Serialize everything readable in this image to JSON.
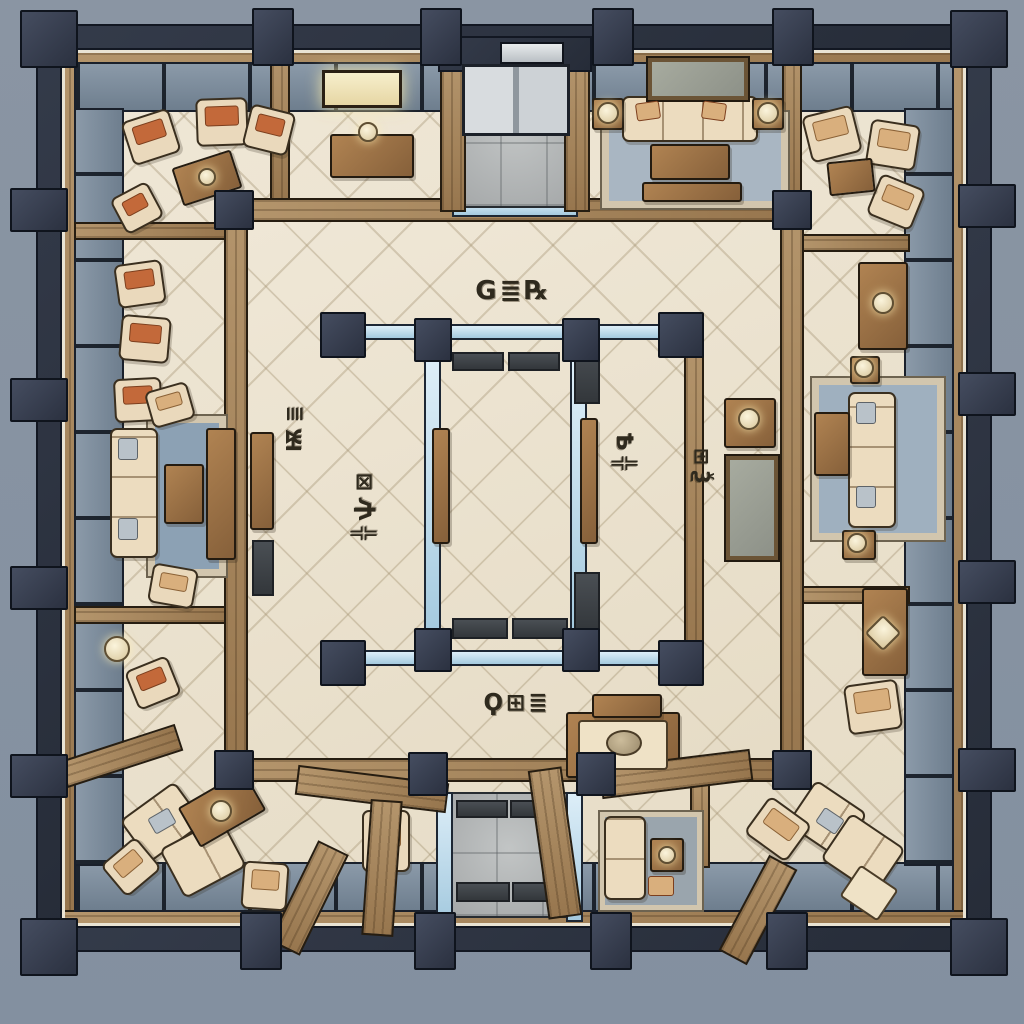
{
  "scene": {
    "description": "Hand-drawn top-down floor plan of a square building: dark structural frame with columns, perimeter wood and glass walls, beige tiled lounge rooms with sofas and armchairs, central grey stone court with elevator and glass partitions",
    "view": "top-down"
  },
  "labels": {
    "north_room": "G≣℞",
    "west_wing": "Ѭ≣",
    "court_west": "╬ѱ⊠",
    "court_east": "Ѣ╬",
    "east_wing": "⊞Ѯ",
    "south_room": "Ϙ⊞≣"
  },
  "palette": {
    "background": "#8793a1",
    "frame_dark": "#2e3442",
    "column": "#3b4254",
    "wood_light": "#b4956c",
    "wood_dark": "#86603a",
    "glass_outer": "#74828f",
    "glass_inner_light": "#bfdcee",
    "tile_floor": "#ece3d0",
    "stone_floor": "#b2b5b5",
    "sofa_cream": "#ecdcbf",
    "cushion_orange": "#c3693a",
    "cushion_tan": "#d9af7d",
    "rug_blue": "#9fb0bf",
    "rug_border": "#d2c6ae",
    "ink_outline": "#1c1f27",
    "label_ink": "#2f2a1e"
  }
}
